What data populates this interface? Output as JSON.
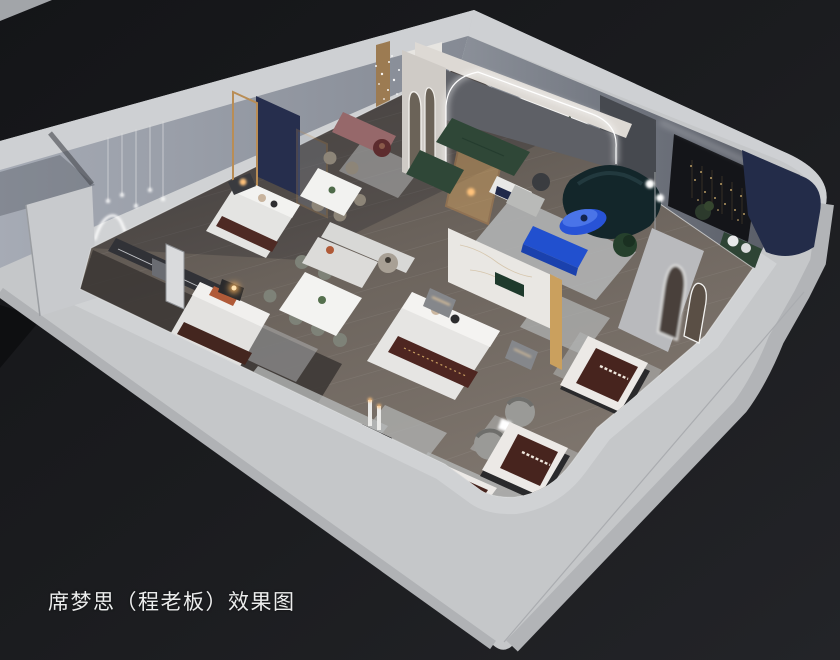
{
  "caption": {
    "text": "席梦思（程老板）效果图"
  },
  "scene": {
    "type": "3d-interior-rendering",
    "subject": "isometric cutaway floor plan of a Simmons mattress showroom",
    "view": "top-down oblique cutaway, dark studio background",
    "rooms": [
      "bedroom-display-top-left",
      "bedroom-display-bottom-left",
      "dining-display-upper",
      "dining-display-lower",
      "living-lounge-with-arch-wall",
      "dark-gallery-room-right",
      "mattress-display-floor-front"
    ],
    "objects": [
      "bed-display-1",
      "bed-display-2",
      "bed-display-main",
      "mattress-display-1",
      "mattress-display-2",
      "mattress-display-3",
      "dining-set-1",
      "dining-set-2",
      "green-sectional-sofa",
      "teal-curved-sofa",
      "blue-coffee-table",
      "blue-console",
      "rose-console",
      "marble-partition",
      "navy-panels-gold-frames",
      "arch-led-wall",
      "arch-mirror-partition",
      "barrel-lounge-chairs",
      "wavy-neon-wall-light",
      "pendant-bulb-lights",
      "crystal-chandelier",
      "gold-sparkle-branch-lights",
      "backlit-white-panel",
      "palm-plant"
    ]
  },
  "palette": {
    "background_dark_left": "#141518",
    "background_dark_right": "#232428",
    "wall_band_light": "#c5c7c9",
    "wall_face_cool": "#9aa0aa",
    "wall_face_shadow": "#5d616b",
    "floor_wood": "#6e665f",
    "floor_dark_room": "#3b3734",
    "rug_gray": "#b4b6b7",
    "sofa_green": "#2f4737",
    "sofa_teal_dark": "#13262a",
    "accent_blue": "#2853d6",
    "panel_navy": "#262e4d",
    "marble_white": "#e9e7e3",
    "brass_gold": "#c9a063",
    "mattress_brown": "#45231e",
    "accent_rust": "#b05a38",
    "wood_frame": "#b0804e",
    "warm_light": "#ffc27a",
    "led_white": "#ffffff",
    "caption_white": "#eceded"
  }
}
